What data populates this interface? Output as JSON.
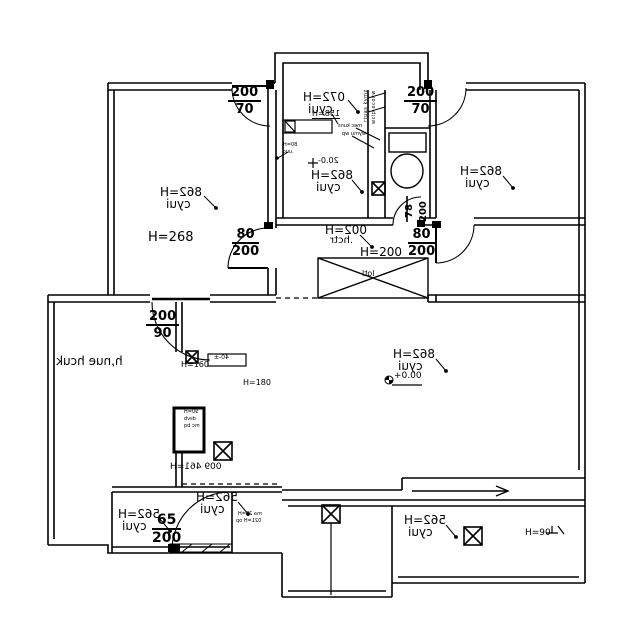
{
  "colors": {
    "ink": "#000000",
    "paper": "#ffffff"
  },
  "rooms": {
    "upper_left": {
      "height": "H=268",
      "name": "iuyc"
    },
    "upper_left_alt": "H=268",
    "top_center": {
      "height": "H=270",
      "name": "iuyc"
    },
    "lobby": {
      "height": "H=268",
      "name": "iuyc",
      "level": "-0.02"
    },
    "right": {
      "height": "H=268",
      "name": "iuyc"
    },
    "hall": {
      "height": "H=200",
      "name": "rtch.",
      "plain_height": "H=200",
      "shaft": "ltol"
    },
    "living": {
      "height": "H=268",
      "name": "iuyc",
      "level": "+0.00"
    },
    "kitchen": {
      "name": "kuch eun,h",
      "h160": "H=160",
      "h180": "H=180",
      "h164": "H=164 900",
      "top_note": "±-04",
      "pillar": [
        "H=09",
        "bvsd",
        "qb cm"
      ]
    },
    "closet": {
      "height": "H=265",
      "name": "iuyc"
    },
    "bottom_center": {
      "height": "H=265",
      "name": "iuyc",
      "note1": "H=52 am",
      "note2": "po H=120"
    },
    "bottom_right": {
      "height": "H=265",
      "name": "iuyc",
      "h90": "H=90"
    }
  },
  "openings": {
    "window_left": {
      "a": "200",
      "b": "70"
    },
    "window_right": {
      "a": "200",
      "b": "70"
    },
    "door_upper_left": {
      "a": "80",
      "b": "200"
    },
    "door_upper_right": {
      "a": "80",
      "b": "200"
    },
    "door_kitchen": {
      "a": "200",
      "b": "90"
    },
    "door_closet": {
      "a": "65",
      "b": "200"
    },
    "door_bath": {
      "a": "78",
      "b": "200"
    },
    "niche": "H=851"
  },
  "tiny_notes": {
    "vent1": "zmyk sautr",
    "vent2": "wkoce picw",
    "lobby1": "H=08",
    "lobby2": "cuu.",
    "bath1": "snuk cem",
    "bath2": "pw umyw"
  }
}
